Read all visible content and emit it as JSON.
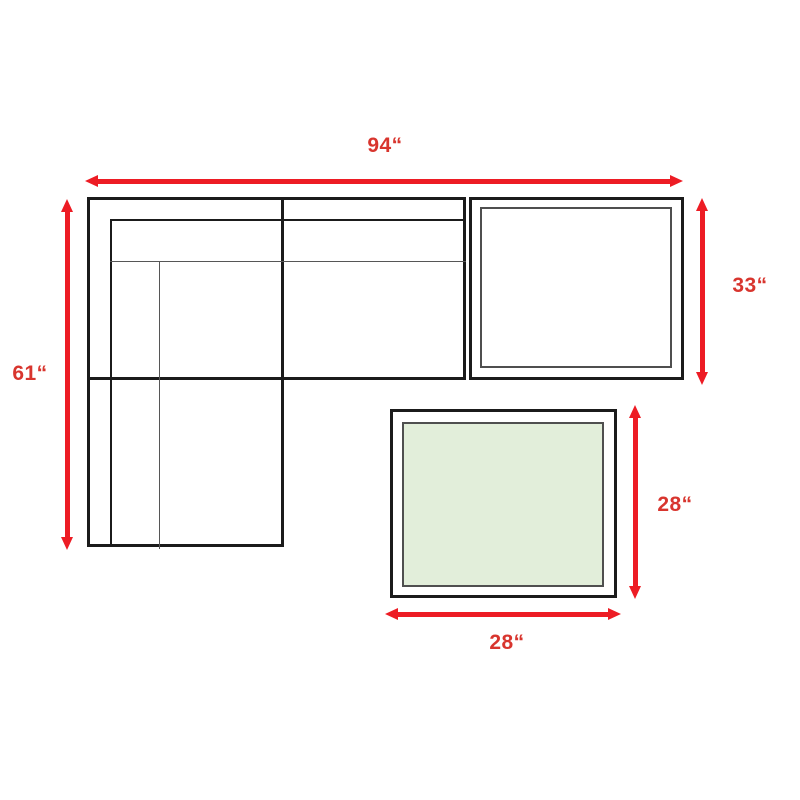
{
  "colors": {
    "background": "#ffffff",
    "arrow_color": "#ed1c24",
    "label_color": "#d8352e",
    "outline_color": "#1b1b1b",
    "inner_line_color": "#4f4f4f",
    "thin_line_color": "#565656",
    "ottoman_fill": "#e2eeda"
  },
  "labels": {
    "sofa_width": "94“",
    "sofa_height": "61“",
    "corner_section_depth": "33“",
    "ottoman_depth": "28“",
    "ottoman_width": "28“"
  }
}
